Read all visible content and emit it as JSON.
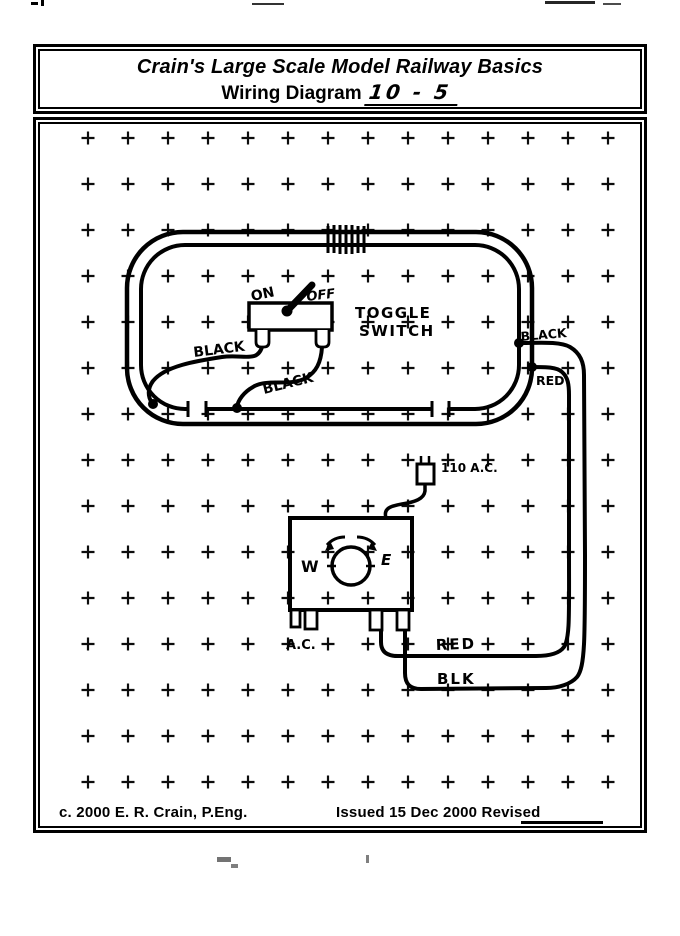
{
  "title": {
    "line1": "Crain's Large Scale Model Railway Basics",
    "line2_label": "Wiring Diagram",
    "diagram_number": "10 - 5"
  },
  "diagram": {
    "labels": {
      "on": "ON",
      "off": "OFF",
      "toggle_line1": "TOGGLE",
      "toggle_line2": "SWITCH",
      "feed_black_left": "BLACK",
      "feed_black_mid": "BLACK",
      "tap_black": "BLACK",
      "tap_red": "RED",
      "power": "110 A.C.",
      "dial_west": "W",
      "dial_east": "E",
      "ac_terminals": "A.C.",
      "wire_red": "RED",
      "wire_blk": "BLK"
    }
  },
  "footer": {
    "copyright": "c. 2000 E. R. Crain, P.Eng.",
    "issued": "Issued 15 Dec 2000 Revised"
  },
  "colors": {
    "ink": "#000000",
    "paper": "#ffffff"
  }
}
